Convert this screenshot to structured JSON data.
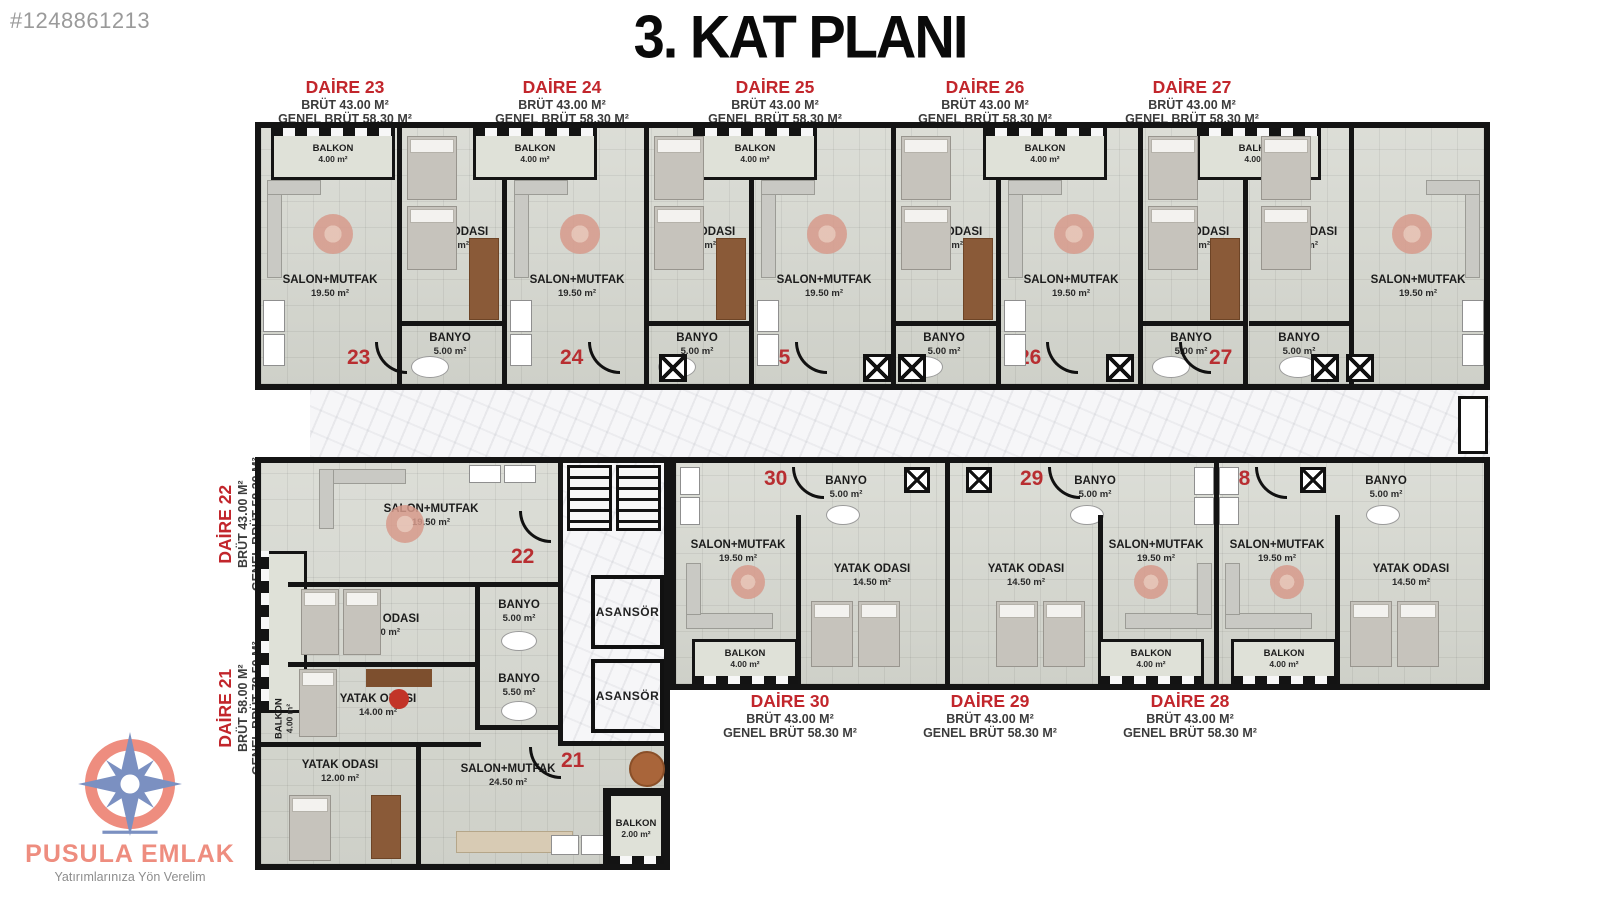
{
  "page": {
    "listing_id": "#1248861213",
    "title": "3. KAT PLANI"
  },
  "logo": {
    "name": "PUSULA EMLAK",
    "slogan": "Yatırımlarınıza Yön Verelim"
  },
  "core": {
    "asansor_top": "ASANSÖR",
    "asansor_bottom": "ASANSÖR"
  },
  "apartments": {
    "a21": {
      "title": "DAİRE 21",
      "brut": "BRÜT 58.00 M²",
      "genel": "GENEL BRÜT 78.50 M²",
      "num": "21",
      "rooms": {
        "yatak1": "YATAK ODASI",
        "yatak1_area": "14.00 m²",
        "yatak2": "YATAK ODASI",
        "yatak2_area": "12.00 m²",
        "salon": "SALON+MUTFAK",
        "salon_area": "24.50 m²",
        "banyo": "BANYO",
        "banyo_area": "5.50 m²",
        "balkon": "BALKON",
        "balkon_area": "2.00 m²"
      }
    },
    "a22": {
      "title": "DAİRE 22",
      "brut": "BRÜT 43.00 M²",
      "genel": "GENEL BRÜT 58.30 M²",
      "num": "22",
      "rooms": {
        "balkon": "BALKON",
        "balkon_area": "4.00 m²",
        "salon": "SALON+MUTFAK",
        "salon_area": "19.50 m²",
        "yatak": "YATAK ODASI",
        "yatak_area": "14.50 m²",
        "banyo": "BANYO",
        "banyo_area": "5.00 m²"
      }
    },
    "a23": {
      "title": "DAİRE 23",
      "brut": "BRÜT 43.00 M²",
      "genel": "GENEL BRÜT 58.30 M²",
      "num": "23",
      "rooms": {
        "balkon": "BALKON",
        "balkon_area": "4.00 m²",
        "salon": "SALON+MUTFAK",
        "salon_area": "19.50 m²",
        "yatak": "YATAK ODASI",
        "yatak_area": "14.50 m²",
        "banyo": "BANYO",
        "banyo_area": "5.00 m²"
      }
    },
    "a24": {
      "title": "DAİRE 24",
      "brut": "BRÜT 43.00 M²",
      "genel": "GENEL BRÜT 58.30 M²",
      "num": "24",
      "rooms": {
        "balkon": "BALKON",
        "balkon_area": "4.00 m²",
        "salon": "SALON+MUTFAK",
        "salon_area": "19.50 m²",
        "yatak": "YATAK ODASI",
        "yatak_area": "14.50 m²",
        "banyo": "BANYO",
        "banyo_area": "5.00 m²"
      }
    },
    "a25": {
      "title": "DAİRE 25",
      "brut": "BRÜT 43.00 M²",
      "genel": "GENEL BRÜT 58.30 M²",
      "num": "25",
      "rooms": {
        "balkon": "BALKON",
        "balkon_area": "4.00 m²",
        "salon": "SALON+MUTFAK",
        "salon_area": "19.50 m²",
        "yatak": "YATAK ODASI",
        "yatak_area": "14.50 m²",
        "banyo": "BANYO",
        "banyo_area": "5.00 m²"
      }
    },
    "a26": {
      "title": "DAİRE 26",
      "brut": "BRÜT 43.00 M²",
      "genel": "GENEL BRÜT 58.30 M²",
      "num": "26",
      "rooms": {
        "balkon": "BALKON",
        "balkon_area": "4.00 m²",
        "salon": "SALON+MUTFAK",
        "salon_area": "19.50 m²",
        "yatak": "YATAK ODASI",
        "yatak_area": "14.50 m²",
        "banyo": "BANYO",
        "banyo_area": "5.00 m²"
      }
    },
    "a27": {
      "title": "DAİRE 27",
      "brut": "BRÜT 43.00 M²",
      "genel": "GENEL BRÜT 58.30 M²",
      "num": "27",
      "rooms": {
        "balkon": "BALKON",
        "balkon_area": "4.00 m²",
        "salon": "SALON+MUTFAK",
        "salon_area": "19.50 m²",
        "yatak": "YATAK ODASI",
        "yatak_area": "14.50 m²",
        "banyo": "BANYO",
        "banyo_area": "5.00 m²"
      }
    },
    "a28": {
      "title": "DAİRE 28",
      "brut": "BRÜT 43.00 M²",
      "genel": "GENEL BRÜT 58.30 M²",
      "num": "28",
      "rooms": {
        "balkon": "BALKON",
        "balkon_area": "4.00 m²",
        "salon": "SALON+MUTFAK",
        "salon_area": "19.50 m²",
        "yatak": "YATAK ODASI",
        "yatak_area": "14.50 m²",
        "banyo": "BANYO",
        "banyo_area": "5.00 m²"
      }
    },
    "a29": {
      "title": "DAİRE 29",
      "brut": "BRÜT 43.00 M²",
      "genel": "GENEL BRÜT 58.30 M²",
      "num": "29",
      "rooms": {
        "balkon": "BALKON",
        "balkon_area": "4.00 m²",
        "salon": "SALON+MUTFAK",
        "salon_area": "19.50 m²",
        "yatak": "YATAK ODASI",
        "yatak_area": "14.50 m²",
        "banyo": "BANYO",
        "banyo_area": "5.00 m²"
      }
    },
    "a30": {
      "title": "DAİRE 30",
      "brut": "BRÜT 43.00 M²",
      "genel": "GENEL BRÜT 58.30 M²",
      "num": "30",
      "rooms": {
        "balkon": "BALKON",
        "balkon_area": "4.00 m²",
        "salon": "SALON+MUTFAK",
        "salon_area": "19.50 m²",
        "yatak": "YATAK ODASI",
        "yatak_area": "14.50 m²",
        "banyo": "BANYO",
        "banyo_area": "5.00 m²"
      }
    }
  }
}
